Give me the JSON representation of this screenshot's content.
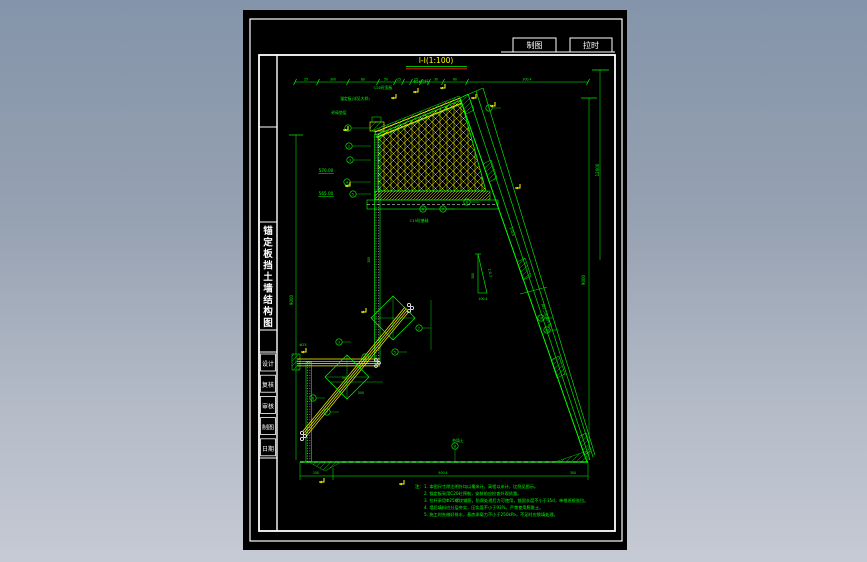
{
  "window": {
    "bg_top": "#8494aa",
    "bg_bottom": "#c5cad4",
    "canvas_bg": "#000000"
  },
  "toolbar_tabs": [
    {
      "label": "制图"
    },
    {
      "label": "拉时"
    }
  ],
  "title_block": {
    "drawing_title_vertical": "锚定板挡土墙结构图",
    "cells": [
      {
        "label": "设计"
      },
      {
        "label": "复核"
      },
      {
        "label": "审核"
      },
      {
        "label": "制图"
      },
      {
        "label": "日期"
      }
    ]
  },
  "drawing": {
    "view_title": "Ⅰ-Ⅰ(1:100)",
    "colors": {
      "line": "#00ff00",
      "accent": "#ffff00",
      "white": "#ffffff",
      "red": "#ff2020"
    },
    "labels": [
      {
        "t": "25",
        "x": 63,
        "y": 70.5
      },
      {
        "t": "300",
        "x": 90,
        "y": 70.5
      },
      {
        "t": "80",
        "x": 120,
        "y": 70.5
      },
      {
        "t": "50",
        "x": 143,
        "y": 70.5
      },
      {
        "t": "25",
        "x": 156,
        "y": 70.5
      },
      {
        "t": "25",
        "x": 173,
        "y": 70.5
      },
      {
        "t": "30",
        "x": 193,
        "y": 70.5
      },
      {
        "t": "60",
        "x": 212,
        "y": 70.5
      },
      {
        "t": "300.4",
        "x": 284,
        "y": 70.5
      },
      {
        "t": "锚定板(详见大样)",
        "x": 112,
        "y": 90,
        "s": 3.8
      },
      {
        "t": "C20砼面板",
        "x": 140,
        "y": 79,
        "s": 3.8
      },
      {
        "t": "Φ25拉杆",
        "x": 178,
        "y": 73,
        "s": 3.8
      },
      {
        "t": "砂砾垫层",
        "x": 96,
        "y": 104,
        "s": 3.8
      },
      {
        "t": "C15砼基础",
        "x": 176,
        "y": 212,
        "s": 3.8
      },
      {
        "t": "570.00",
        "x": 83,
        "y": 162,
        "s": 4.2,
        "u": true
      },
      {
        "t": "565.00",
        "x": 83,
        "y": 185,
        "s": 4.2,
        "u": true
      },
      {
        "t": "9000",
        "x": 50,
        "y": 290,
        "s": 4,
        "r": -90
      },
      {
        "t": "9000",
        "x": 342,
        "y": 270,
        "s": 4,
        "r": -90
      },
      {
        "t": "12000",
        "x": 356,
        "y": 160,
        "s": 4,
        "r": -90
      },
      {
        "t": "1:0.5",
        "x": 268,
        "y": 222,
        "s": 3.8,
        "r": 71
      },
      {
        "t": "M7.5浆砌片石",
        "x": 302,
        "y": 306,
        "s": 3.8,
        "r": 71
      },
      {
        "t": "300",
        "x": 231,
        "y": 266,
        "s": 3.2,
        "r": -90
      },
      {
        "t": "1:0.3",
        "x": 246,
        "y": 263,
        "s": 3.4,
        "r": 77
      },
      {
        "t": "100.4",
        "x": 240,
        "y": 290,
        "s": 3.2
      },
      {
        "t": "150",
        "x": 73,
        "y": 464,
        "s": 3.2
      },
      {
        "t": "900.4",
        "x": 200,
        "y": 464,
        "s": 3.2
      },
      {
        "t": "300",
        "x": 330,
        "y": 464,
        "s": 3.2
      },
      {
        "t": "50",
        "x": 101,
        "y": 369,
        "s": 3.2
      },
      {
        "t": "500",
        "x": 118,
        "y": 384,
        "s": 3.2
      },
      {
        "t": "45°",
        "x": 137,
        "y": 331,
        "s": 3.4
      },
      {
        "t": "夯填土",
        "x": 215,
        "y": 432,
        "s": 3.8
      },
      {
        "t": "300",
        "x": 127,
        "y": 250,
        "s": 3.2,
        "r": -90
      },
      {
        "t": "Φ25",
        "x": 60,
        "y": 336,
        "s": 3.4
      }
    ],
    "leaders": [
      {
        "x": 105,
        "y": 118,
        "n": "1",
        "lx": 128
      },
      {
        "x": 106,
        "y": 136,
        "n": "2",
        "lx": 128
      },
      {
        "x": 107,
        "y": 150,
        "n": "3",
        "lx": 128
      },
      {
        "x": 104,
        "y": 172,
        "n": "4",
        "lx": 128
      },
      {
        "x": 110,
        "y": 184,
        "n": "5",
        "lx": 128
      },
      {
        "x": 180,
        "y": 199,
        "n": "6"
      },
      {
        "x": 200,
        "y": 199,
        "n": "7"
      },
      {
        "x": 224,
        "y": 192,
        "n": "8"
      },
      {
        "x": 298,
        "y": 308,
        "n": "9"
      },
      {
        "x": 304,
        "y": 320,
        "n": "10"
      },
      {
        "x": 96,
        "y": 332,
        "n": "3"
      },
      {
        "x": 122,
        "y": 347,
        "n": "4"
      },
      {
        "x": 152,
        "y": 342,
        "n": "5"
      },
      {
        "x": 176,
        "y": 318,
        "n": "2"
      },
      {
        "x": 70,
        "y": 388,
        "n": "6"
      },
      {
        "x": 84,
        "y": 402,
        "n": "7"
      },
      {
        "x": 212,
        "y": 436,
        "n": "8",
        "ly": 452
      },
      {
        "x": 246,
        "y": 98,
        "n": "1"
      }
    ],
    "flags": [
      {
        "x": 148,
        "y": 88
      },
      {
        "x": 170,
        "y": 82
      },
      {
        "x": 197,
        "y": 78
      },
      {
        "x": 228,
        "y": 88
      },
      {
        "x": 247,
        "y": 96
      },
      {
        "x": 272,
        "y": 178
      },
      {
        "x": 58,
        "y": 342
      },
      {
        "x": 118,
        "y": 302
      },
      {
        "x": 100,
        "y": 120
      },
      {
        "x": 102,
        "y": 176
      },
      {
        "x": 76,
        "y": 472
      },
      {
        "x": 156,
        "y": 474
      }
    ],
    "notes": {
      "prefix": "注：",
      "lines": [
        "1. 本图尺寸除注明外均以毫米计，高程以米计，比例见图示。",
        "2. 锚定板采用C20砼预制，安装前应检查外观质量。",
        "3. 拉杆采用Φ25螺纹钢筋，防腐处理后方可使用，锚固长度不小于35d，单根逐根张拉。",
        "4. 墙后填料应分层夯实，压实度不小于93%，严禁使用膨胀土。",
        "5. 施工时先做好排水，基底承载力不小于250kPa，不足时应换填处理。"
      ]
    }
  }
}
